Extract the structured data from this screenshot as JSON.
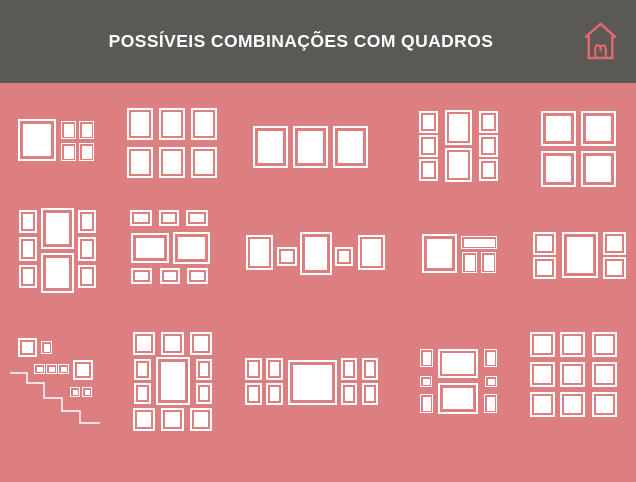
{
  "header": {
    "title": "POSSÍVEIS COMBINAÇÕES COM QUADROS"
  },
  "colors": {
    "header_bg": "#5a5955",
    "board_bg": "#dd7e80",
    "frame": "#ffffff",
    "logo": "#e5696f"
  },
  "board": {
    "layouts": [
      {
        "id": "one-large-four-small",
        "frames": [
          [
            18,
            36,
            38,
            42
          ],
          [
            61,
            38,
            15,
            18
          ],
          [
            79,
            38,
            15,
            18
          ],
          [
            61,
            60,
            15,
            18
          ],
          [
            79,
            60,
            15,
            18
          ]
        ]
      },
      {
        "id": "grid-2x3-portrait",
        "frames": [
          [
            127,
            25,
            26,
            32
          ],
          [
            159,
            25,
            26,
            32
          ],
          [
            191,
            25,
            26,
            32
          ],
          [
            127,
            64,
            26,
            31
          ],
          [
            159,
            64,
            26,
            31
          ],
          [
            191,
            64,
            26,
            31
          ]
        ]
      },
      {
        "id": "three-in-a-row",
        "frames": [
          [
            253,
            43,
            35,
            42
          ],
          [
            293,
            43,
            35,
            42
          ],
          [
            333,
            43,
            35,
            42
          ]
        ]
      },
      {
        "id": "columns-3-2-3-small",
        "frames": [
          [
            419,
            28,
            19,
            22
          ],
          [
            419,
            52,
            19,
            22
          ],
          [
            419,
            76,
            19,
            22
          ],
          [
            445,
            27,
            27,
            35
          ],
          [
            445,
            65,
            27,
            34
          ],
          [
            479,
            28,
            19,
            22
          ],
          [
            479,
            52,
            19,
            22
          ],
          [
            479,
            76,
            19,
            22
          ]
        ]
      },
      {
        "id": "four-squares-2x2",
        "frames": [
          [
            541,
            28,
            35,
            35
          ],
          [
            581,
            28,
            35,
            35
          ],
          [
            541,
            68,
            35,
            36
          ],
          [
            581,
            68,
            35,
            36
          ]
        ]
      },
      {
        "id": "columns-3-2-3-large",
        "frames": [
          [
            19,
            127,
            18,
            23
          ],
          [
            19,
            154,
            18,
            24
          ],
          [
            19,
            182,
            18,
            23
          ],
          [
            41,
            125,
            33,
            41
          ],
          [
            41,
            170,
            33,
            40
          ],
          [
            78,
            127,
            18,
            23
          ],
          [
            78,
            154,
            18,
            24
          ],
          [
            78,
            182,
            18,
            23
          ]
        ]
      },
      {
        "id": "rows-3-2-3-landscape",
        "frames": [
          [
            130,
            127,
            22,
            16
          ],
          [
            159,
            127,
            20,
            16
          ],
          [
            186,
            127,
            22,
            16
          ],
          [
            131,
            150,
            38,
            30
          ],
          [
            173,
            149,
            37,
            32
          ],
          [
            131,
            185,
            21,
            16
          ],
          [
            160,
            185,
            20,
            16
          ],
          [
            187,
            185,
            21,
            16
          ]
        ]
      },
      {
        "id": "symmetric-row-of-five",
        "frames": [
          [
            246,
            152,
            27,
            35
          ],
          [
            277,
            164,
            20,
            19
          ],
          [
            300,
            149,
            32,
            43
          ],
          [
            335,
            164,
            18,
            19
          ],
          [
            358,
            152,
            27,
            35
          ]
        ]
      },
      {
        "id": "large-square-strip-two-small",
        "frames": [
          [
            422,
            151,
            35,
            39
          ],
          [
            461,
            153,
            36,
            13
          ],
          [
            462,
            169,
            15,
            21
          ],
          [
            481,
            169,
            15,
            21
          ]
        ]
      },
      {
        "id": "columns-2-1-2",
        "frames": [
          [
            533,
            149,
            23,
            23
          ],
          [
            533,
            174,
            23,
            22
          ],
          [
            562,
            149,
            36,
            46
          ],
          [
            603,
            149,
            23,
            23
          ],
          [
            603,
            174,
            23,
            22
          ]
        ]
      },
      {
        "id": "staircase-arrangement",
        "frames": [
          [
            18,
            255,
            19,
            19
          ],
          [
            41,
            258,
            11,
            13
          ],
          [
            34,
            281,
            11,
            10
          ],
          [
            46,
            281,
            11,
            10
          ],
          [
            58,
            281,
            11,
            10
          ],
          [
            73,
            277,
            20,
            20
          ],
          [
            70,
            304,
            10,
            10
          ],
          [
            82,
            304,
            10,
            10
          ]
        ],
        "stairs": [
          [
            10,
            290
          ],
          [
            27,
            290
          ],
          [
            27,
            300
          ],
          [
            44,
            300
          ],
          [
            44,
            315
          ],
          [
            62,
            315
          ],
          [
            62,
            328
          ],
          [
            80,
            328
          ],
          [
            80,
            340
          ],
          [
            100,
            340
          ]
        ]
      },
      {
        "id": "ring-around-center",
        "frames": [
          [
            133,
            249,
            22,
            23
          ],
          [
            161,
            249,
            23,
            23
          ],
          [
            190,
            249,
            22,
            23
          ],
          [
            134,
            276,
            17,
            21
          ],
          [
            134,
            300,
            17,
            21
          ],
          [
            156,
            274,
            34,
            48
          ],
          [
            196,
            276,
            16,
            21
          ],
          [
            196,
            300,
            16,
            21
          ],
          [
            133,
            325,
            22,
            23
          ],
          [
            161,
            325,
            23,
            23
          ],
          [
            190,
            325,
            22,
            23
          ]
        ]
      },
      {
        "id": "four-center-landscape-four",
        "frames": [
          [
            245,
            275,
            17,
            22
          ],
          [
            266,
            275,
            17,
            22
          ],
          [
            245,
            300,
            17,
            22
          ],
          [
            266,
            300,
            17,
            22
          ],
          [
            288,
            277,
            49,
            45
          ],
          [
            341,
            275,
            16,
            22
          ],
          [
            362,
            275,
            16,
            22
          ],
          [
            341,
            300,
            16,
            22
          ],
          [
            362,
            300,
            16,
            22
          ]
        ]
      },
      {
        "id": "sides-and-two-landscape",
        "frames": [
          [
            420,
            266,
            13,
            18
          ],
          [
            420,
            293,
            12,
            11
          ],
          [
            420,
            311,
            13,
            19
          ],
          [
            438,
            266,
            40,
            29
          ],
          [
            438,
            300,
            40,
            31
          ],
          [
            484,
            266,
            13,
            18
          ],
          [
            485,
            293,
            12,
            11
          ],
          [
            484,
            311,
            13,
            19
          ]
        ]
      },
      {
        "id": "grid-3x3-squares",
        "frames": [
          [
            530,
            249,
            25,
            25
          ],
          [
            560,
            249,
            25,
            25
          ],
          [
            592,
            249,
            25,
            25
          ],
          [
            530,
            279,
            25,
            25
          ],
          [
            560,
            279,
            25,
            25
          ],
          [
            592,
            279,
            25,
            25
          ],
          [
            530,
            309,
            25,
            25
          ],
          [
            560,
            309,
            25,
            25
          ],
          [
            592,
            309,
            25,
            25
          ]
        ]
      }
    ]
  }
}
